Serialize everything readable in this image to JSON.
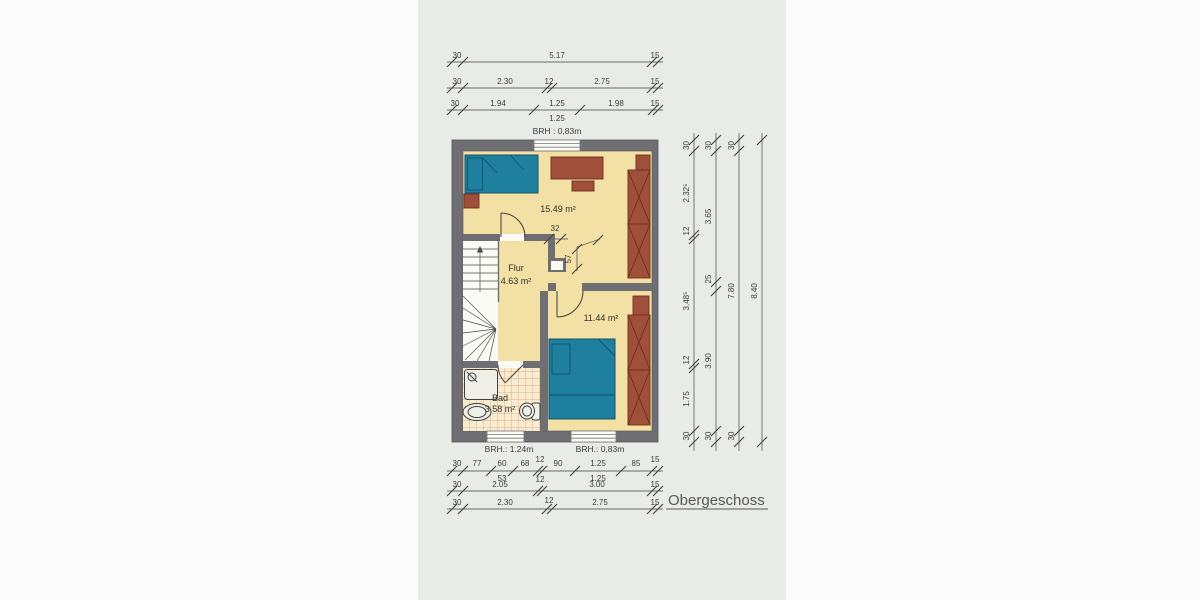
{
  "title": "Obergeschoss",
  "rooms": {
    "bedroom_large": {
      "area": "15.49 m²"
    },
    "hall": {
      "name": "Flur",
      "area": "4.63 m²"
    },
    "bedroom_small": {
      "area": "11.44 m²"
    },
    "bath": {
      "name": "Bad",
      "area": "3.58 m²"
    }
  },
  "windows": {
    "top": "BRH : 0,83m",
    "bottom_left": "BRH.: 1.24m",
    "bottom_right": "BRH.: 0,83m"
  },
  "interior_dims": {
    "door_wall": "32",
    "niche": "57"
  },
  "dims": {
    "top_row1": [
      "30",
      "5.17",
      "15"
    ],
    "top_row2": [
      "30",
      "2.30",
      "12",
      "2.75",
      "15"
    ],
    "top_row3": [
      "30",
      "1.94",
      "1.25",
      "1.98",
      "15"
    ],
    "top_row3_sub": "1.25",
    "bottom_row1": [
      "30",
      "77",
      "60",
      "68",
      "12",
      "90",
      "1.25",
      "85",
      "15"
    ],
    "bottom_row1_sub": [
      "53",
      "12",
      "1.25"
    ],
    "bottom_row2": [
      "30",
      "2.05",
      "3.00",
      "15"
    ],
    "bottom_row3": [
      "30",
      "2.30",
      "12",
      "2.75",
      "15"
    ],
    "right_col1": [
      "30",
      "2.32⁵",
      "12",
      "3.48⁵",
      "12",
      "1.75",
      "30"
    ],
    "right_col2": [
      "30",
      "3.65",
      "25",
      "3.90",
      "30"
    ],
    "right_col3": [
      "30",
      "7.80",
      "30"
    ],
    "right_col4": [
      "8.40"
    ]
  },
  "colors": {
    "background": "#e9ebe6",
    "wall": "#6f6e72",
    "floor": "#f2e0a4",
    "bed": "#1f7f9e",
    "furniture": "#a0503a",
    "tile_line": "#dc9a62"
  }
}
